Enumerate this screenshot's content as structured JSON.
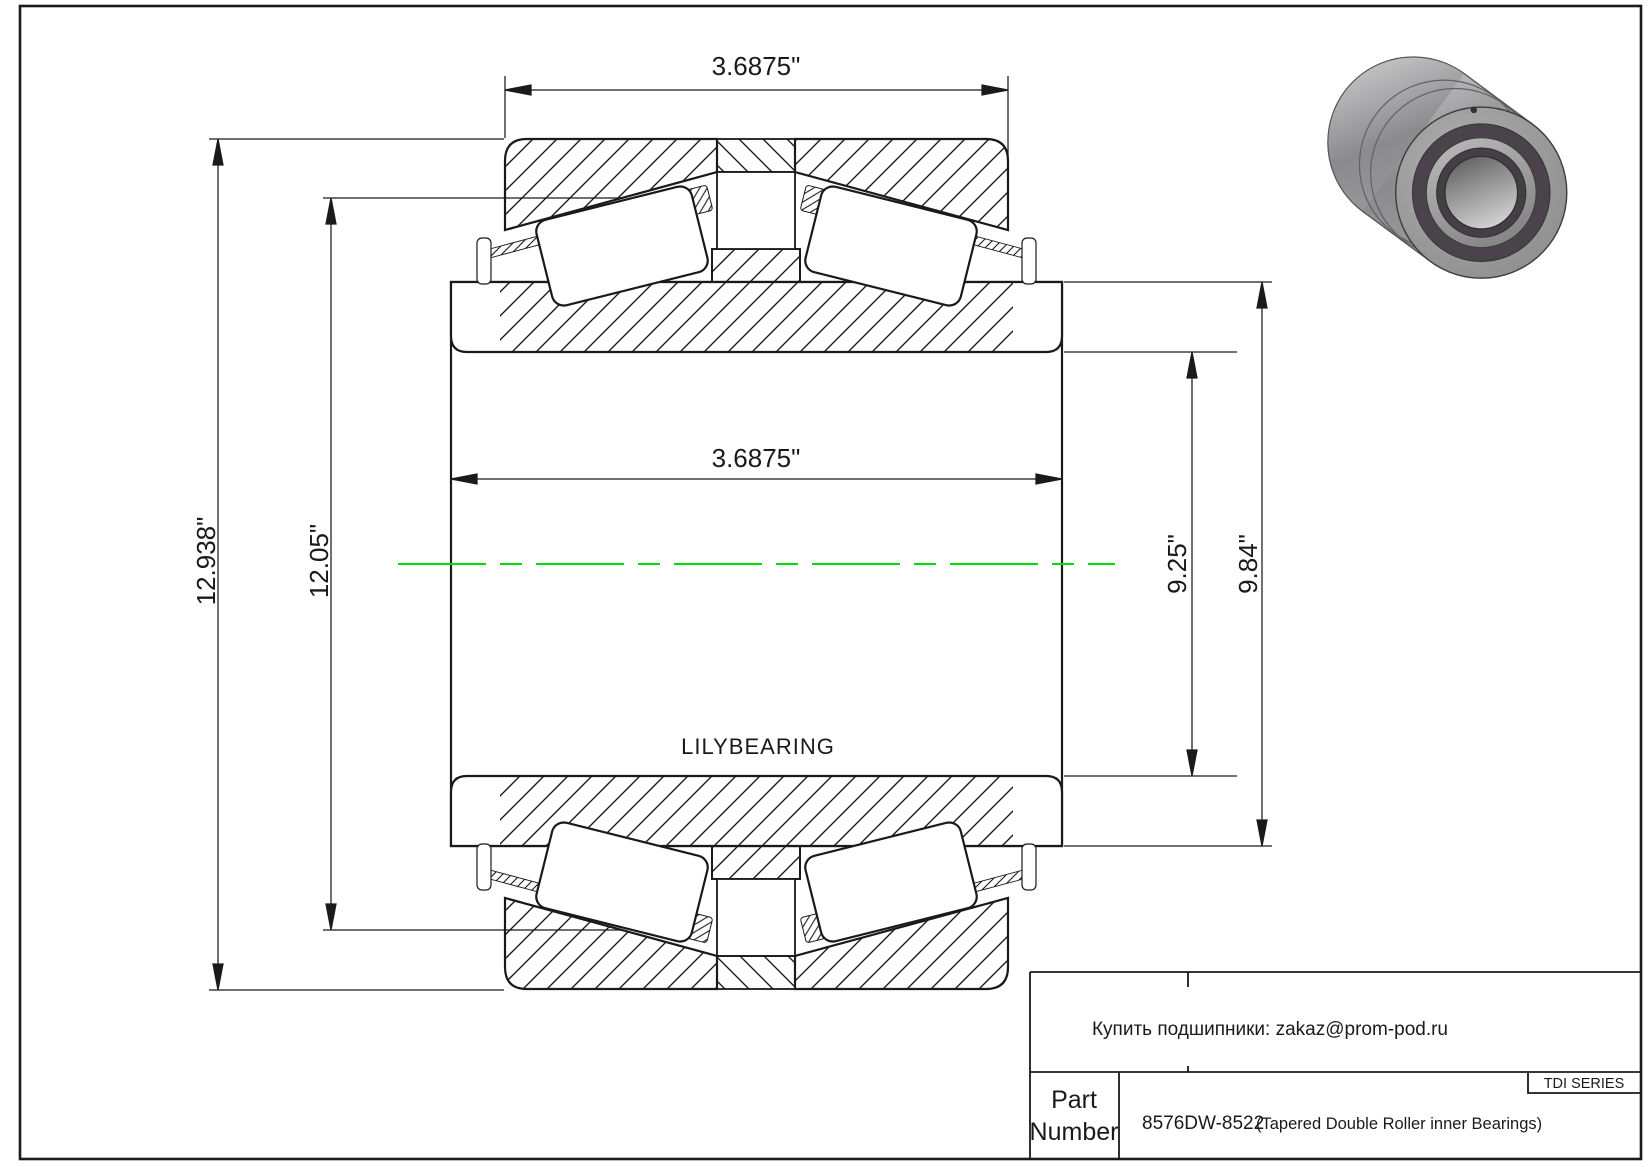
{
  "colors": {
    "line": "#1a1a1a",
    "centerline": "#00dd00",
    "background": "#ffffff"
  },
  "drawing": {
    "brand_label": "LILYBEARING",
    "dimensions": {
      "cup_width_top": "3.6875\"",
      "cone_width": "3.6875\"",
      "outside_diameter": "12.938\"",
      "cup_diameter": "12.05\"",
      "race_diameter": "9.25\"",
      "cone_rib_diameter": "9.84\""
    }
  },
  "images": {
    "bearing_render": "3d-tapered-roller-bearing-photo"
  },
  "title_block": {
    "contact": "Купить подшипники: zakaz@prom-pod.ru",
    "series_badge": "TDI SERIES",
    "part_label_line1": "Part",
    "part_label_line2": "Number",
    "part_number": "8576DW-8522",
    "part_description": "(Tapered Double Roller inner Bearings)"
  }
}
